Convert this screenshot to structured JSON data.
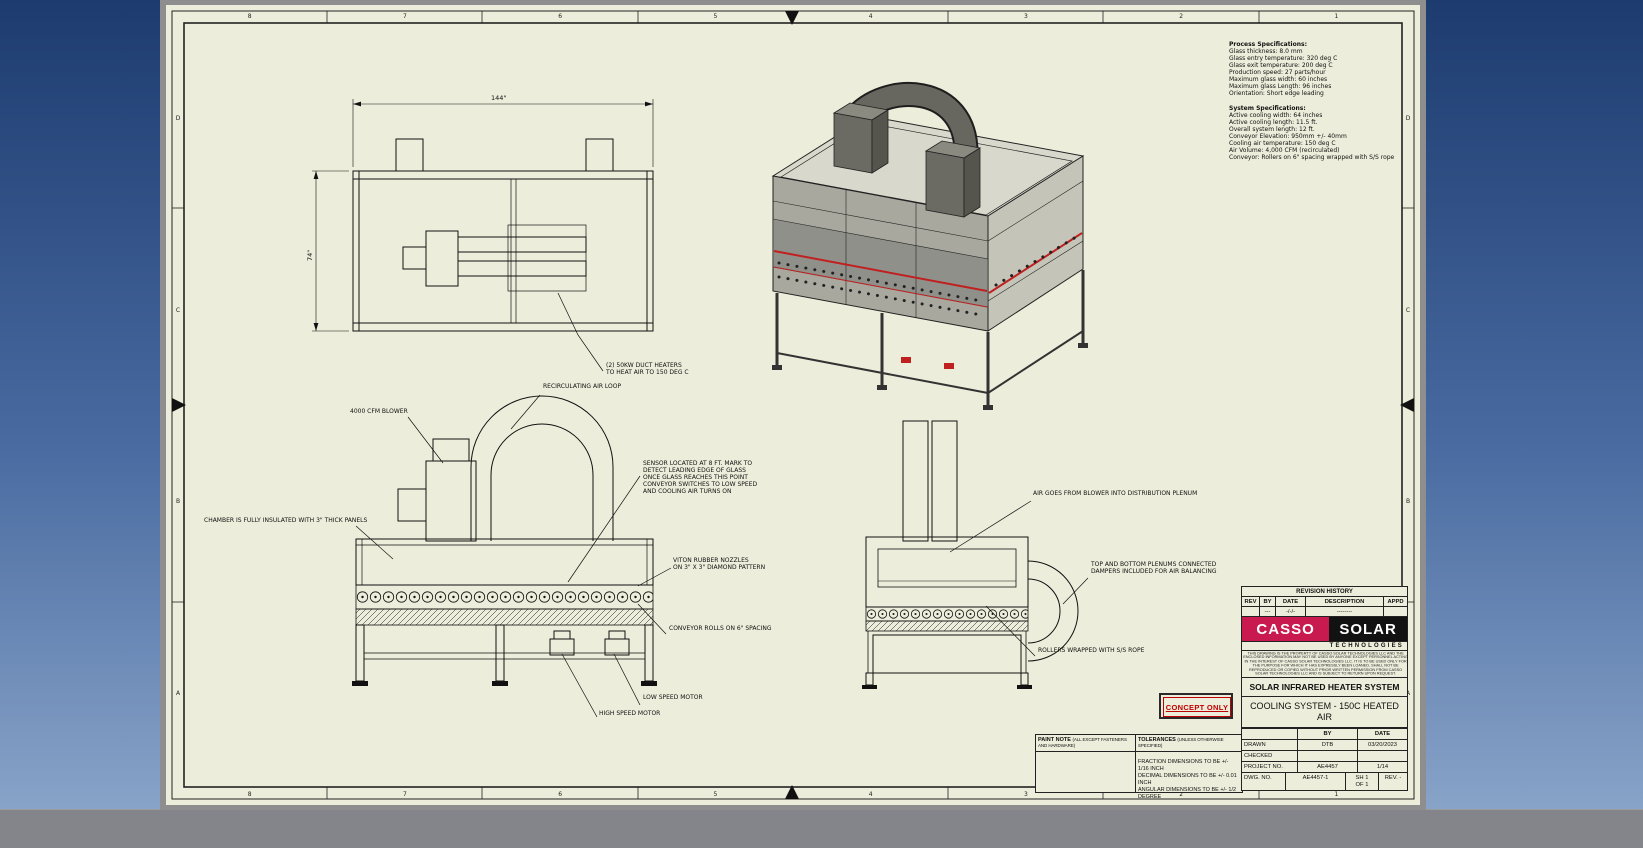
{
  "sheet": {
    "zone_numbers": [
      "8",
      "7",
      "6",
      "5",
      "4",
      "3",
      "2",
      "1"
    ],
    "zone_letters": [
      "D",
      "C",
      "B",
      "A"
    ]
  },
  "specs": {
    "process_title": "Process Specifications:",
    "process_body": "Glass thickness: 8.0 mm\nGlass entry temperature: 320 deg C\nGlass exit temperature: 200 deg C\nProduction speed: 27 parts/hour\nMaximum glass width: 60 inches\nMaximum glass Length: 96 inches\nOrientation: Short edge leading",
    "system_title": "System Specifications:",
    "system_body": "Active cooling width: 64 inches\nActive cooling length: 11.5 ft.\nOverall system length: 12 ft.\nConveyor Elevation: 950mm +/- 40mm\nCooling air temperature: 150 deg C\nAir Volume: 4,000 CFM (recirculated)\nConveyor: Rollers on 6\" spacing wrapped with S/S rope"
  },
  "dimensions": {
    "plan_length": "144\"",
    "plan_width": "74\""
  },
  "callouts": {
    "duct_heaters": "(2) 50KW DUCT HEATERS\nTO HEAT AIR TO 150 DEG C",
    "recirculating": "RECIRCULATING AIR LOOP",
    "blower": "4000 CFM BLOWER",
    "sensor": "SENSOR LOCATED AT 8 FT. MARK TO\nDETECT LEADING EDGE OF GLASS\nONCE GLASS REACHES THIS POINT\nCONVEYOR SWITCHES TO LOW SPEED\nAND COOLING AIR TURNS ON",
    "chamber": "CHAMBER IS FULLY INSULATED WITH 3\" THICK PANELS",
    "nozzles": "VITON RUBBER NOZZLES\nON 3\" X 3\" DIAMOND PATTERN",
    "conveyor_rolls": "CONVEYOR ROLLS ON 6\" SPACING",
    "high_speed_motor": "HIGH SPEED MOTOR",
    "low_speed_motor": "LOW SPEED MOTOR",
    "air_distribution": "AIR GOES FROM BLOWER INTO DISTRIBUTION PLENUM",
    "plenums": "TOP AND BOTTOM PLENUMS CONNECTED\nDAMPERS INCLUDED FOR AIR BALANCING",
    "rollers_rope": "ROLLERS WRAPPED WITH S/S ROPE"
  },
  "revision_history": {
    "title": "REVISION HISTORY",
    "headers": [
      "REV",
      "BY",
      "DATE",
      "DESCRIPTION",
      "APPD"
    ],
    "row": [
      "",
      "---",
      "-/-/-",
      "--------",
      ""
    ]
  },
  "logo": {
    "word1": "CASSO",
    "word2": "SOLAR",
    "tagline": "TECHNOLOGIES"
  },
  "legal_note": "THIS DRAWING IS THE PROPERTY OF CASSO SOLAR TECHNOLOGIES LLC AND THE ENCLOSED INFORMATION MAY NOT BE USED BY ANYONE EXCEPT PERSONNEL ACTING IN THE INTEREST OF CASSO SOLAR TECHNOLOGIES LLC. IT IS TO BE USED ONLY FOR THE PURPOSE FOR WHICH IT HAS EXPRESSLY BEEN LOANED, SHALL NOT BE REPRODUCED OR COPIED WITHOUT PRIOR WRITTEN PERMISSION FROM CASSO SOLAR TECHNOLOGIES LLC AND IS SUBJECT TO RETURN UPON REQUEST.",
  "stamp": "CONCEPT ONLY",
  "titleblock": {
    "system_line": "SOLAR INFRARED HEATER SYSTEM",
    "drawing_title": "COOLING SYSTEM - 150C HEATED\nAIR",
    "col_by": "BY",
    "col_date": "DATE",
    "drawn_label": "DRAWN",
    "drawn_by": "DTB",
    "drawn_date": "03/20/2023",
    "checked_label": "CHECKED",
    "project_label": "PROJECT NO.",
    "project_no": "AE4457",
    "project_scale": "1/14",
    "dwg_label": "DWG. NO.",
    "dwg_no": "AE4457-1",
    "sheet_no": "SH 1\nOF 1",
    "rev": "REV. -"
  },
  "paint_note": {
    "title": "PAINT NOTE",
    "subtitle": "(ALL EXCEPT FASTENERS AND HARDWARE)"
  },
  "tolerances": {
    "title": "TOLERANCES",
    "subtitle": "(UNLESS OTHERWISE SPECIFIED)",
    "body": "FRACTION DIMENSIONS TO BE +/- 1/16 INCH\nDECIMAL DIMENSIONS TO BE +/- 0.01 INCH\nANGULAR DIMENSIONS TO BE +/- 1/2 DEGREE"
  }
}
